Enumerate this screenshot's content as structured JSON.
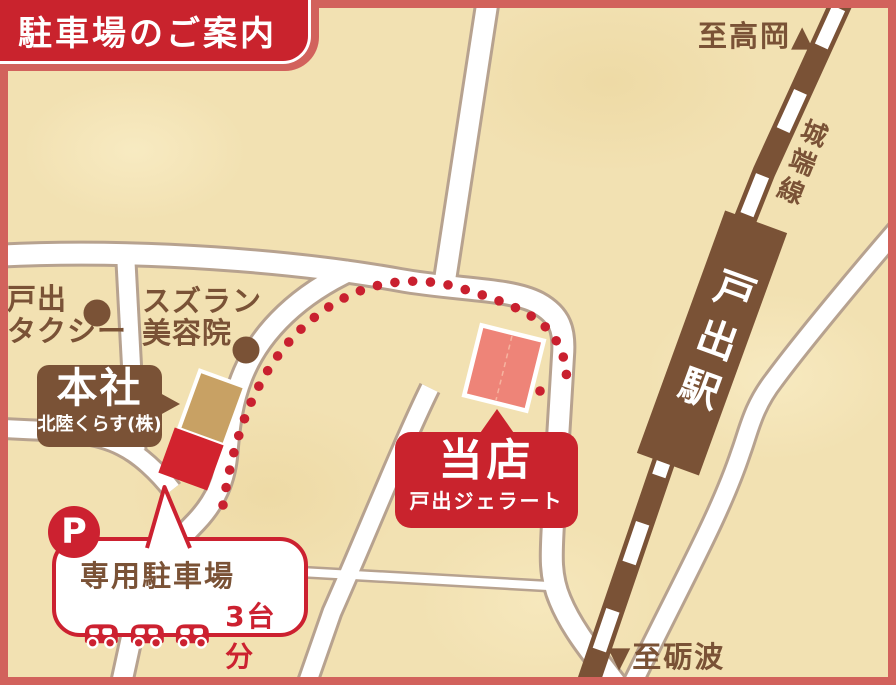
{
  "title": "駐車場のご案内",
  "directions": {
    "top": "至高岡▲",
    "bottom": "▼至砺波"
  },
  "railway": {
    "line_name": "城端線",
    "station_name": "戸出駅"
  },
  "pois": [
    {
      "id": "toide-taxi",
      "line1": "戸出",
      "line2": "タクシー"
    },
    {
      "id": "suzuran-salon",
      "line1": "スズラン",
      "line2": "美容院"
    }
  ],
  "head_office": {
    "label": "本社",
    "company": "北陸くらす(株)"
  },
  "shop": {
    "label": "当店",
    "name": "戸出ジェラート"
  },
  "parking": {
    "badge": "P",
    "label": "専用駐車場",
    "capacity_label": "3台分",
    "car_count": 3
  },
  "colors": {
    "accent_red": "#c9232d",
    "dot_red": "#c9202f",
    "brown": "#7a5236",
    "frame_salmon": "#d2625c",
    "road_casing": "#b7a28f",
    "beige": "#f2e1b2",
    "shop_building": "#ee8478",
    "gold_building": "#c8a164"
  }
}
